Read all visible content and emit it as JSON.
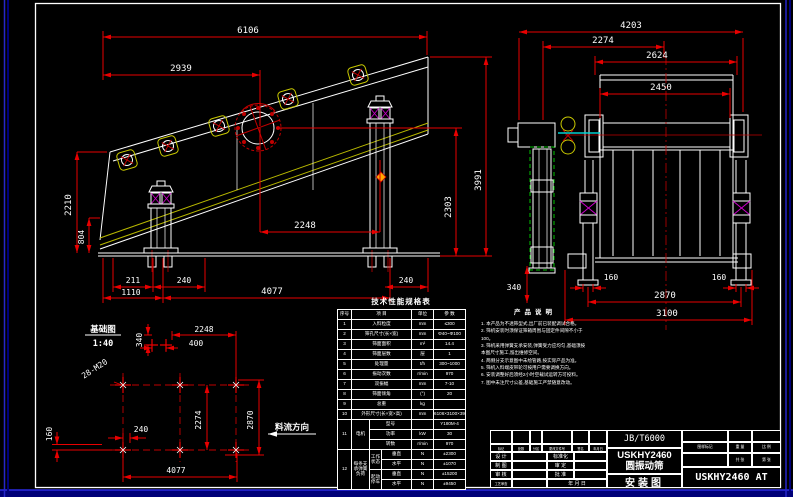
{
  "side_view": {
    "dims": {
      "a6106": "6106",
      "a2939": "2939",
      "a2210": "2210",
      "a804": "804",
      "a211": "211",
      "a240L": "240",
      "a1110": "1110",
      "a4077": "4077",
      "a240R": "240",
      "a2248": "2248",
      "a2303": "2303",
      "a3991": "3991"
    }
  },
  "end_view": {
    "dims": {
      "a4203": "4203",
      "a2274": "2274",
      "a2624": "2624",
      "a2450": "2450",
      "a340": "340",
      "a160L": "160",
      "a160R": "160",
      "a2870": "2870",
      "a3100": "3100"
    }
  },
  "foundation": {
    "labels": {
      "title": "基础图",
      "scale": "1:40",
      "anchor_bolts": "28-M20",
      "flow_direction": "料流方向"
    },
    "dims": {
      "a2248": "2248",
      "a400": "400",
      "a340": "340",
      "a2274": "2274",
      "a2870": "2870",
      "a160": "160",
      "a240": "240",
      "a4077": "4077"
    }
  },
  "spec_table": {
    "title": "技术性能规格表",
    "headers": [
      "序号",
      "项  目",
      "单位",
      "参  数"
    ],
    "rows": [
      [
        "1",
        "入料粒度",
        "mm",
        "≤300"
      ],
      [
        "2",
        "筛孔尺寸(长×宽)",
        "mm",
        "Φ40~Φ100"
      ],
      [
        "3",
        "筛面面积",
        "m²",
        "14.4"
      ],
      [
        "4",
        "筛面层数",
        "层",
        "1"
      ],
      [
        "5",
        "处理量",
        "t/h",
        "300~1000"
      ],
      [
        "6",
        "振动次数",
        "r/min",
        "970"
      ],
      [
        "7",
        "双振幅",
        "mm",
        "7-10"
      ],
      [
        "8",
        "筛面倾角",
        "(°)",
        "20"
      ],
      [
        "9",
        "总重",
        "kg",
        ""
      ],
      [
        "10",
        "外形尺寸(长×宽×高)",
        "mm",
        "6106×3100×3991"
      ]
    ],
    "motor": {
      "no": "11",
      "label": "电机",
      "rows": [
        [
          "型号",
          "",
          "Y180M-4"
        ],
        [
          "功率",
          "kW",
          "30"
        ],
        [
          "转数",
          "r/min",
          "970"
        ]
      ]
    },
    "spring": {
      "no": "12",
      "label": "每条支承弹簧负荷",
      "groups": [
        {
          "state": "工作状态",
          "rows": [
            [
              "垂直",
              "N",
              "±2300"
            ],
            [
              "水平",
              "N",
              "±1070"
            ]
          ]
        },
        {
          "state": "起动停车",
          "rows": [
            [
              "垂直",
              "N",
              "±15200"
            ],
            [
              "水平",
              "N",
              "±9450"
            ]
          ]
        }
      ]
    }
  },
  "notes": {
    "title": "产品说明",
    "items": [
      "1. 本产品为不透筛型式,出厂前已装配调试合格。",
      "2. 筛机安装时须保证筛箱周围与固定件间隙不小于100。",
      "3. 筛机采用弹簧支承安装,弹簧受力应均匀,基础须按本图尺寸施工,留出维修空间。",
      "4. 两侧分支示意图中未绘管路,按实际产品为准。",
      "5. 筛机入料端皮带轮可按用户需要调换方向。",
      "6. 安装调整好后须经2小时空载试运转方可投料。",
      "7. 图中未注尺寸公差,基础施工严禁随意改动。"
    ]
  },
  "title_block": {
    "standard_code": "JB/T6000",
    "model": "USKHY2460",
    "product": "圆振动筛",
    "sheet_name": "安装图",
    "drawing_number": "USKHY2460 AT",
    "revision_strip": [
      "标记",
      "处数",
      "分区",
      "更改文件号",
      "签名",
      "年月日"
    ],
    "fields": {
      "design": "设 计",
      "draft": "制 图",
      "check": "审 核",
      "process": "工艺审查",
      "standardize": "标准化",
      "approve_tech": "审 定",
      "approve": "批 准",
      "date": "年 月 日"
    },
    "right": {
      "mark": "图样标记",
      "weight": "重 量",
      "scale": "比 例",
      "sheets": "共  张",
      "sheet_no": "第  张"
    }
  }
}
